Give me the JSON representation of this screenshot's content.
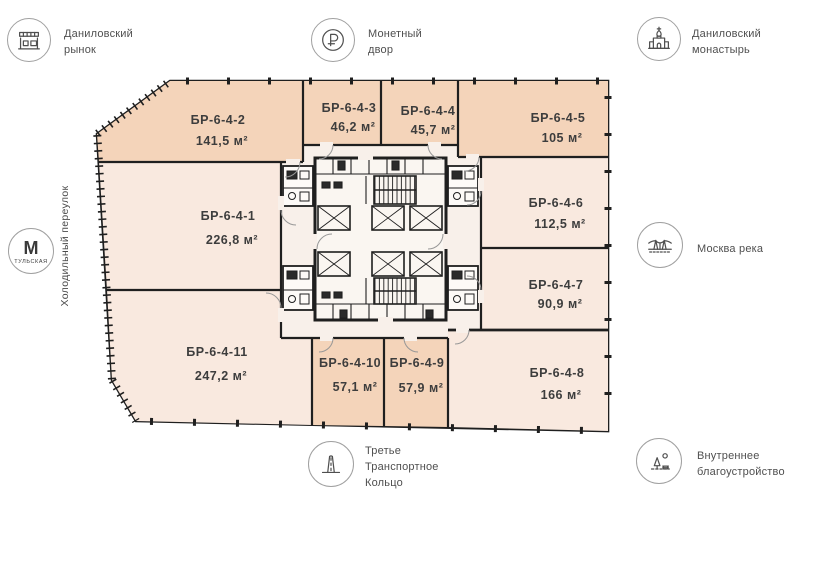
{
  "landmarks": {
    "market": {
      "label": "Даниловский\nрынок"
    },
    "mint": {
      "label": "Монетный\nдвор"
    },
    "monastery": {
      "label": "Даниловский\nмонастырь"
    },
    "river": {
      "label": "Москва река"
    },
    "ring_road": {
      "label": "Третье\nТранспортное\nКольцо"
    },
    "landscaping": {
      "label": "Внутреннее\nблагоустройство"
    },
    "metro": {
      "letter": "М",
      "station": "ТУЛЬСКАЯ"
    },
    "street": {
      "label": "Холодильный переулок"
    }
  },
  "plan": {
    "rooms": [
      {
        "name": "БР-6-4-1",
        "area": "226,8 м²"
      },
      {
        "name": "БР-6-4-2",
        "area": "141,5 м²"
      },
      {
        "name": "БР-6-4-3",
        "area": "46,2 м²"
      },
      {
        "name": "БР-6-4-4",
        "area": "45,7 м²"
      },
      {
        "name": "БР-6-4-5",
        "area": "105 м²"
      },
      {
        "name": "БР-6-4-6",
        "area": "112,5 м²"
      },
      {
        "name": "БР-6-4-7",
        "area": "90,9 м²"
      },
      {
        "name": "БР-6-4-8",
        "area": "166 м²"
      },
      {
        "name": "БР-6-4-9",
        "area": "57,9 м²"
      },
      {
        "name": "БР-6-4-10",
        "area": "57,1 м²"
      },
      {
        "name": "БР-6-4-11",
        "area": "247,2 м²"
      }
    ],
    "colors": {
      "dark": "#f4d4ba",
      "light": "#f9e9df",
      "common": "#f8f0ea",
      "core": "#faf6f1",
      "wall": "#1f1f1f"
    }
  }
}
